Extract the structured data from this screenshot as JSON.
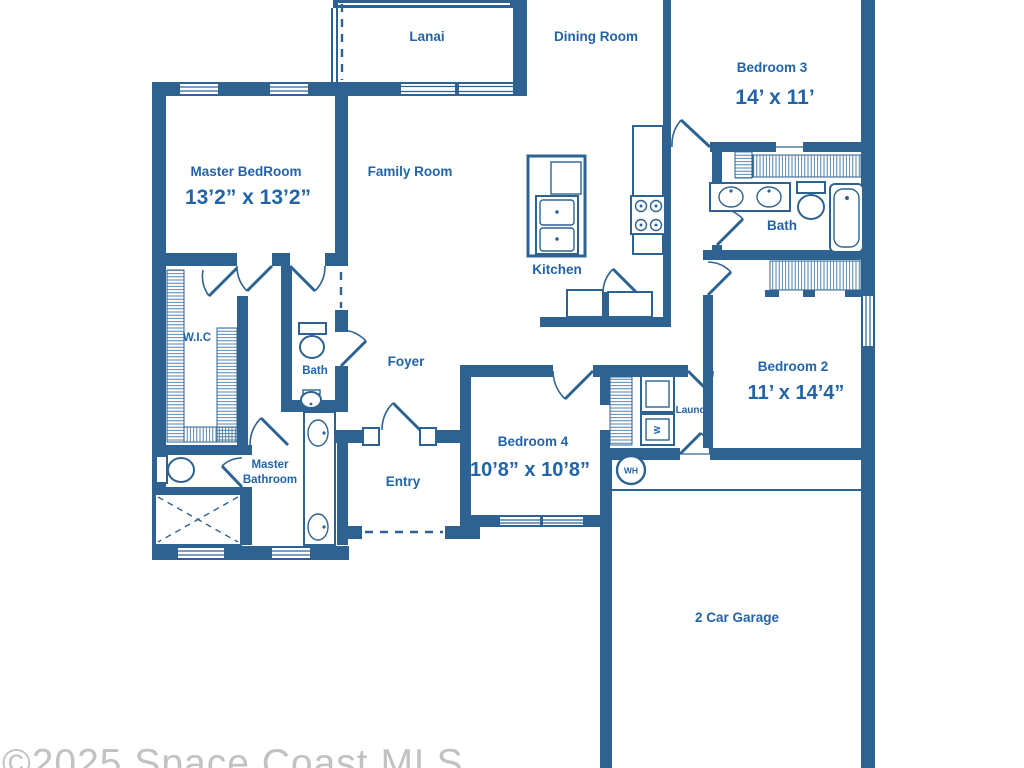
{
  "watermark": "©2025 Space Coast MLS",
  "colors": {
    "wall": "#2e6391",
    "text": "#2164a8",
    "watermark": "#c2c2c2"
  },
  "rooms": {
    "lanai": {
      "label": "Lanai"
    },
    "dining_room": {
      "label": "Dining Room"
    },
    "bedroom3": {
      "label": "Bedroom 3",
      "dims": "14’ x 11’"
    },
    "master_bedroom": {
      "label": "Master BedRoom",
      "dims": "13’2” x 13’2”"
    },
    "family_room": {
      "label": "Family Room"
    },
    "kitchen": {
      "label": "Kitchen"
    },
    "bath_main": {
      "label": "Bath"
    },
    "wic": {
      "label": "W.I.C"
    },
    "bath_hall": {
      "label": "Bath"
    },
    "foyer": {
      "label": "Foyer"
    },
    "bedroom2": {
      "label": "Bedroom 2",
      "dims": "11’ x 14’4”"
    },
    "master_bathroom": {
      "label_line1": "Master",
      "label_line2": "Bathroom"
    },
    "entry": {
      "label": "Entry"
    },
    "bedroom4": {
      "label": "Bedroom 4",
      "dims": "10’8” x 10’8”"
    },
    "laundry": {
      "label": "Laund."
    },
    "garage": {
      "label": "2 Car Garage"
    }
  },
  "fixtures": {
    "water_heater": "WH",
    "washer": "W"
  }
}
